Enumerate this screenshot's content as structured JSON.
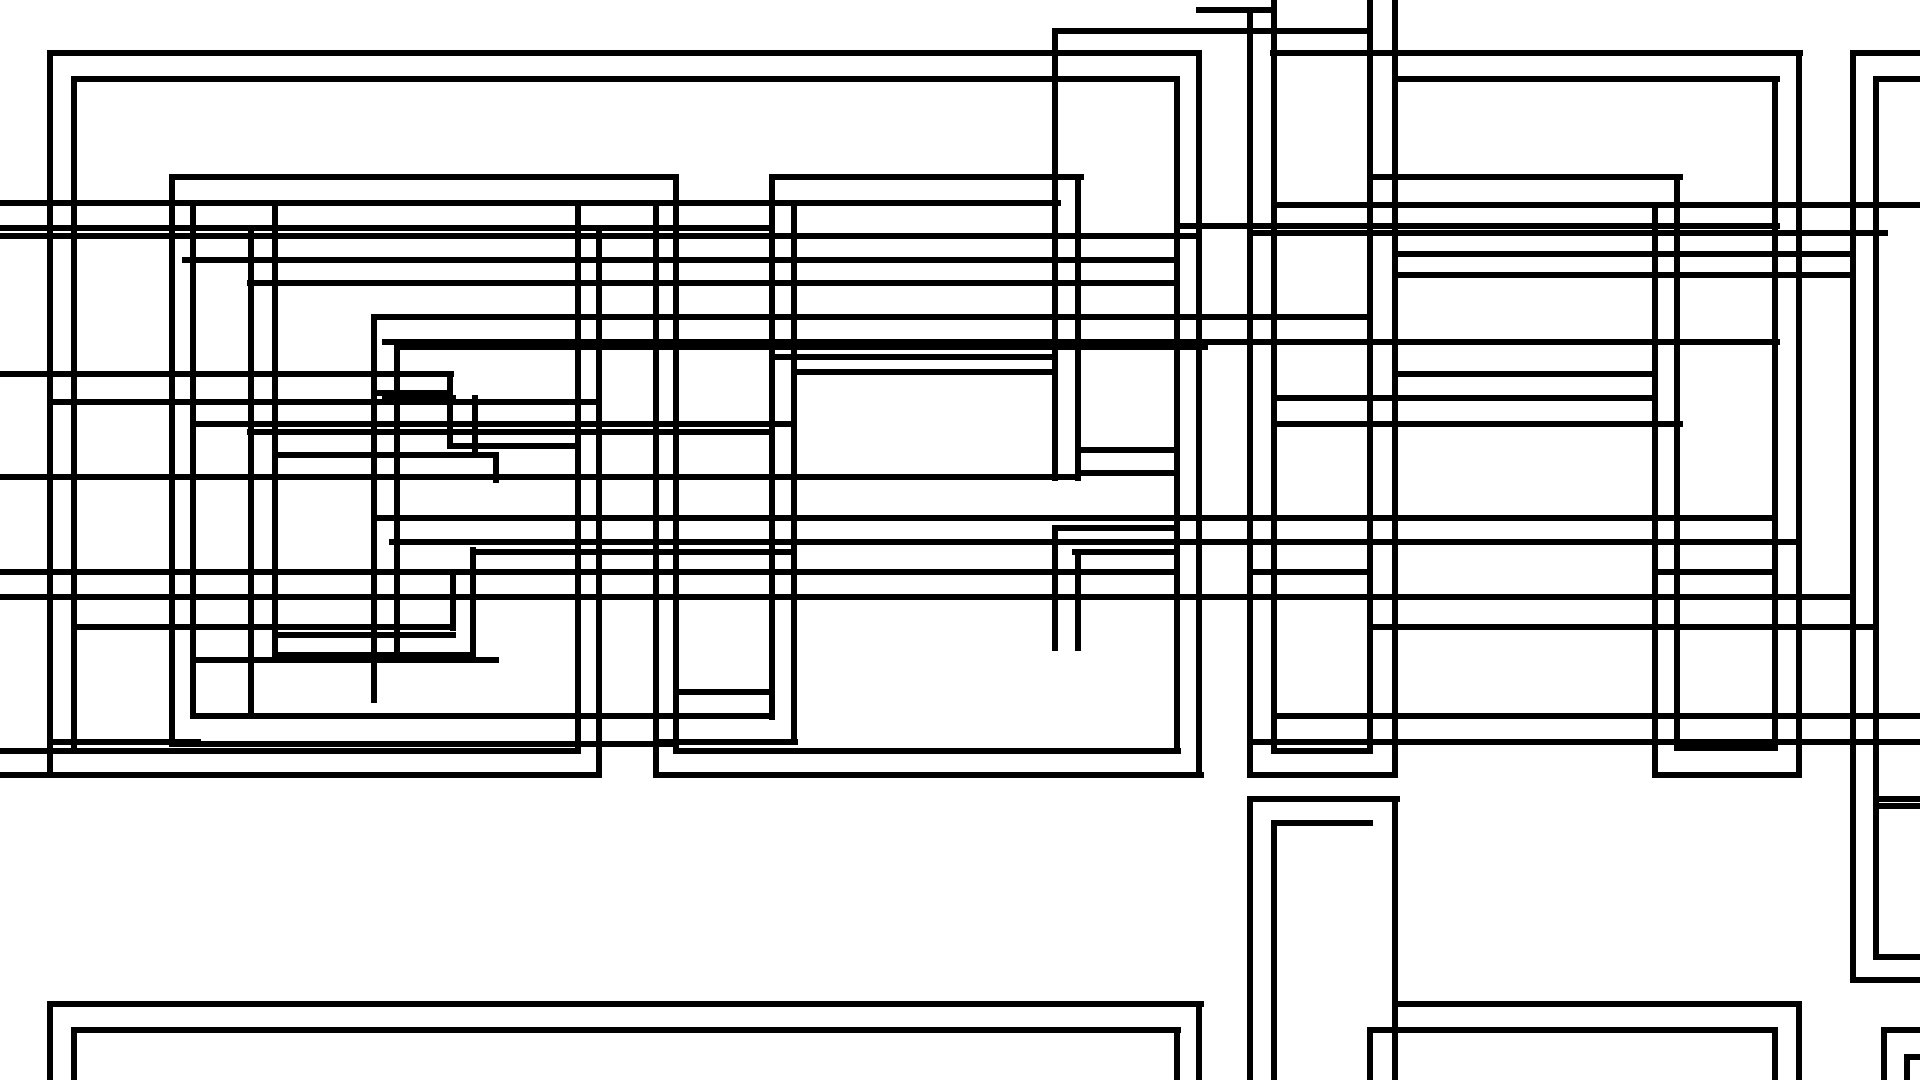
{
  "canvas": {
    "width": 1920,
    "height": 1080,
    "background_color": "#ffffff",
    "stroke_color": "#000000",
    "stroke_width": 6,
    "description": "Abstract line art of many overlapping nested rectangle outlines"
  },
  "hlines": [
    {
      "y": 10,
      "spans": [
        [
          1199,
          1274
        ]
      ]
    },
    {
      "y": 31,
      "spans": [
        [
          1058,
          1370
        ]
      ]
    },
    {
      "y": 53,
      "spans": [
        [
          50,
          1199
        ],
        [
          1273,
          1800
        ],
        [
          1853,
          1920
        ]
      ]
    },
    {
      "y": 79,
      "spans": [
        [
          74,
          1177
        ],
        [
          1395,
          1777
        ],
        [
          1876,
          1920
        ]
      ]
    },
    {
      "y": 177,
      "spans": [
        [
          172,
          676
        ],
        [
          772,
          1081
        ],
        [
          1370,
          1680
        ]
      ]
    },
    {
      "y": 203,
      "spans": [
        [
          0,
          1058
        ]
      ]
    },
    {
      "y": 205,
      "spans": [
        [
          1274,
          1920
        ]
      ]
    },
    {
      "y": 226,
      "spans": [
        [
          1177,
          1777
        ]
      ]
    },
    {
      "y": 228,
      "spans": [
        [
          0,
          772
        ]
      ]
    },
    {
      "y": 233,
      "spans": [
        [
          1250,
          1885
        ]
      ]
    },
    {
      "y": 236,
      "spans": [
        [
          0,
          1199
        ]
      ]
    },
    {
      "y": 254,
      "spans": [
        [
          1395,
          1851
        ]
      ]
    },
    {
      "y": 260,
      "spans": [
        [
          185,
          1177
        ]
      ]
    },
    {
      "y": 275,
      "spans": [
        [
          1395,
          1851
        ]
      ]
    },
    {
      "y": 283,
      "spans": [
        [
          250,
          1177
        ]
      ]
    },
    {
      "y": 317,
      "spans": [
        [
          374,
          1370
        ]
      ]
    },
    {
      "y": 342,
      "spans": [
        [
          385,
          1777
        ]
      ]
    },
    {
      "y": 347,
      "spans": [
        [
          397,
          1205
        ]
      ]
    },
    {
      "y": 357,
      "spans": [
        [
          772,
          1055
        ]
      ]
    },
    {
      "y": 372,
      "spans": [
        [
          794,
          1055
        ]
      ]
    },
    {
      "y": 374,
      "spans": [
        [
          0,
          451
        ],
        [
          1395,
          1655
        ]
      ]
    },
    {
      "y": 393,
      "spans": [
        [
          374,
          450
        ]
      ]
    },
    {
      "y": 398,
      "spans": [
        [
          385,
          453
        ],
        [
          1274,
          1655
        ]
      ]
    },
    {
      "y": 402,
      "spans": [
        [
          50,
          594
        ]
      ]
    },
    {
      "y": 424,
      "spans": [
        [
          199,
          794
        ],
        [
          1274,
          1680
        ]
      ]
    },
    {
      "y": 432,
      "spans": [
        [
          250,
          772
        ]
      ]
    },
    {
      "y": 446,
      "spans": [
        [
          450,
          578
        ]
      ]
    },
    {
      "y": 450,
      "spans": [
        [
          1078,
          1177
        ]
      ]
    },
    {
      "y": 455,
      "spans": [
        [
          275,
          496
        ]
      ]
    },
    {
      "y": 473,
      "spans": [
        [
          1078,
          1177
        ]
      ]
    },
    {
      "y": 477,
      "spans": [
        [
          0,
          1078
        ]
      ]
    },
    {
      "y": 518,
      "spans": [
        [
          375,
          1775
        ]
      ]
    },
    {
      "y": 528,
      "spans": [
        [
          1055,
          1177
        ]
      ]
    },
    {
      "y": 542,
      "spans": [
        [
          392,
          1799
        ]
      ]
    },
    {
      "y": 552,
      "spans": [
        [
          473,
          794
        ],
        [
          1075,
          1177
        ]
      ]
    },
    {
      "y": 572,
      "spans": [
        [
          0,
          1177
        ],
        [
          1250,
          1370
        ],
        [
          1655,
          1775
        ]
      ]
    },
    {
      "y": 597,
      "spans": [
        [
          0,
          1853
        ]
      ]
    },
    {
      "y": 627,
      "spans": [
        [
          74,
          453
        ],
        [
          1370,
          1876
        ]
      ]
    },
    {
      "y": 635,
      "spans": [
        [
          275,
          453
        ]
      ]
    },
    {
      "y": 655,
      "spans": [
        [
          275,
          473
        ]
      ]
    },
    {
      "y": 660,
      "spans": [
        [
          193,
          496
        ]
      ]
    },
    {
      "y": 692,
      "spans": [
        [
          676,
          772
        ]
      ]
    },
    {
      "y": 716,
      "spans": [
        [
          193,
          772
        ],
        [
          1274,
          1920
        ]
      ]
    },
    {
      "y": 742,
      "spans": [
        [
          50,
          198
        ],
        [
          656,
          795
        ],
        [
          1250,
          1920
        ]
      ]
    },
    {
      "y": 744,
      "spans": [
        [
          172,
          676
        ]
      ]
    },
    {
      "y": 748,
      "spans": [
        [
          1677,
          1775
        ]
      ]
    },
    {
      "y": 751,
      "spans": [
        [
          0,
          578
        ],
        [
          676,
          1178
        ],
        [
          1274,
          1370
        ]
      ]
    },
    {
      "y": 775,
      "spans": [
        [
          0,
          599
        ],
        [
          656,
          1201
        ],
        [
          1250,
          1395
        ],
        [
          1655,
          1799
        ]
      ]
    },
    {
      "y": 799,
      "spans": [
        [
          1250,
          1397
        ],
        [
          1876,
          1920
        ]
      ]
    },
    {
      "y": 806,
      "spans": [
        [
          1876,
          1920
        ]
      ]
    },
    {
      "y": 823,
      "spans": [
        [
          1274,
          1370
        ]
      ]
    },
    {
      "y": 957,
      "spans": [
        [
          1876,
          1920
        ]
      ]
    },
    {
      "y": 980,
      "spans": [
        [
          1853,
          1920
        ]
      ]
    },
    {
      "y": 1004,
      "spans": [
        [
          50,
          1201
        ],
        [
          1397,
          1799
        ]
      ]
    },
    {
      "y": 1030,
      "spans": [
        [
          74,
          1178
        ],
        [
          1370,
          1775
        ],
        [
          1884,
          1920
        ]
      ]
    },
    {
      "y": 1057,
      "spans": [
        [
          1907,
          1920
        ]
      ]
    }
  ],
  "vlines": [
    {
      "x": 50,
      "spans": [
        [
          53,
          775
        ],
        [
          1004,
          1080
        ]
      ]
    },
    {
      "x": 74,
      "spans": [
        [
          79,
          751
        ],
        [
          1030,
          1080
        ]
      ]
    },
    {
      "x": 172,
      "spans": [
        [
          177,
          744
        ]
      ]
    },
    {
      "x": 193,
      "spans": [
        [
          203,
          716
        ]
      ]
    },
    {
      "x": 251,
      "spans": [
        [
          228,
          716
        ]
      ]
    },
    {
      "x": 275,
      "spans": [
        [
          203,
          655
        ]
      ]
    },
    {
      "x": 374,
      "spans": [
        [
          317,
          700
        ]
      ]
    },
    {
      "x": 397,
      "spans": [
        [
          342,
          655
        ]
      ]
    },
    {
      "x": 450,
      "spans": [
        [
          374,
          446
        ]
      ]
    },
    {
      "x": 453,
      "spans": [
        [
          572,
          628
        ]
      ]
    },
    {
      "x": 473,
      "spans": [
        [
          550,
          655
        ]
      ]
    },
    {
      "x": 475,
      "spans": [
        [
          398,
          455
        ]
      ]
    },
    {
      "x": 496,
      "spans": [
        [
          455,
          480
        ]
      ]
    },
    {
      "x": 578,
      "spans": [
        [
          203,
          751
        ]
      ]
    },
    {
      "x": 599,
      "spans": [
        [
          228,
          775
        ]
      ]
    },
    {
      "x": 656,
      "spans": [
        [
          203,
          775
        ]
      ]
    },
    {
      "x": 676,
      "spans": [
        [
          177,
          751
        ]
      ]
    },
    {
      "x": 772,
      "spans": [
        [
          177,
          717
        ]
      ]
    },
    {
      "x": 794,
      "spans": [
        [
          203,
          742
        ]
      ]
    },
    {
      "x": 1055,
      "spans": [
        [
          31,
          478
        ],
        [
          528,
          648
        ]
      ]
    },
    {
      "x": 1078,
      "spans": [
        [
          177,
          478
        ],
        [
          553,
          648
        ]
      ]
    },
    {
      "x": 1177,
      "spans": [
        [
          79,
          751
        ],
        [
          1030,
          1080
        ]
      ]
    },
    {
      "x": 1199,
      "spans": [
        [
          53,
          775
        ],
        [
          1004,
          1080
        ]
      ]
    },
    {
      "x": 1250,
      "spans": [
        [
          10,
          775
        ],
        [
          799,
          1080
        ]
      ]
    },
    {
      "x": 1274,
      "spans": [
        [
          0,
          751
        ],
        [
          823,
          1080
        ]
      ]
    },
    {
      "x": 1370,
      "spans": [
        [
          0,
          751
        ],
        [
          1030,
          1080
        ]
      ]
    },
    {
      "x": 1395,
      "spans": [
        [
          0,
          775
        ],
        [
          799,
          1080
        ]
      ]
    },
    {
      "x": 1655,
      "spans": [
        [
          205,
          775
        ]
      ]
    },
    {
      "x": 1677,
      "spans": [
        [
          177,
          748
        ]
      ]
    },
    {
      "x": 1775,
      "spans": [
        [
          79,
          748
        ],
        [
          1030,
          1080
        ]
      ]
    },
    {
      "x": 1799,
      "spans": [
        [
          53,
          775
        ],
        [
          1004,
          1080
        ]
      ]
    },
    {
      "x": 1853,
      "spans": [
        [
          53,
          980
        ]
      ]
    },
    {
      "x": 1876,
      "spans": [
        [
          79,
          957
        ]
      ]
    },
    {
      "x": 1884,
      "spans": [
        [
          1030,
          1080
        ]
      ]
    },
    {
      "x": 1907,
      "spans": [
        [
          1057,
          1080
        ]
      ]
    }
  ]
}
